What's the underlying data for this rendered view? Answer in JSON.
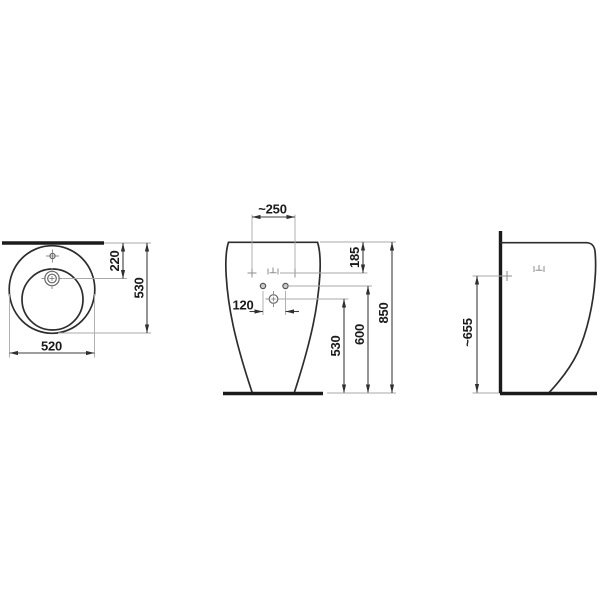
{
  "drawing_type": "washbasin-technical-drawing",
  "colors": {
    "background": "#ffffff",
    "outline": "#2d2d2d",
    "thick_line": "#1b1b1b",
    "dimension_line": "#3c3c3c",
    "extension_line": "#a9a9a9",
    "symbol": "#8e8e8e",
    "text": "#1a1a1a"
  },
  "views": {
    "plan": {
      "label": "top-view",
      "dims": {
        "overall_width": "520",
        "overall_depth": "530",
        "drain_offset": "220"
      }
    },
    "front": {
      "label": "front-view",
      "dims": {
        "rim_width": "~250",
        "overflow_drop": "185",
        "hole_spacing": "120",
        "supply_height": "530",
        "hole_height": "600",
        "overall_height": "850"
      }
    },
    "side": {
      "label": "side-view",
      "dims": {
        "fixing_height": "~655"
      }
    }
  }
}
